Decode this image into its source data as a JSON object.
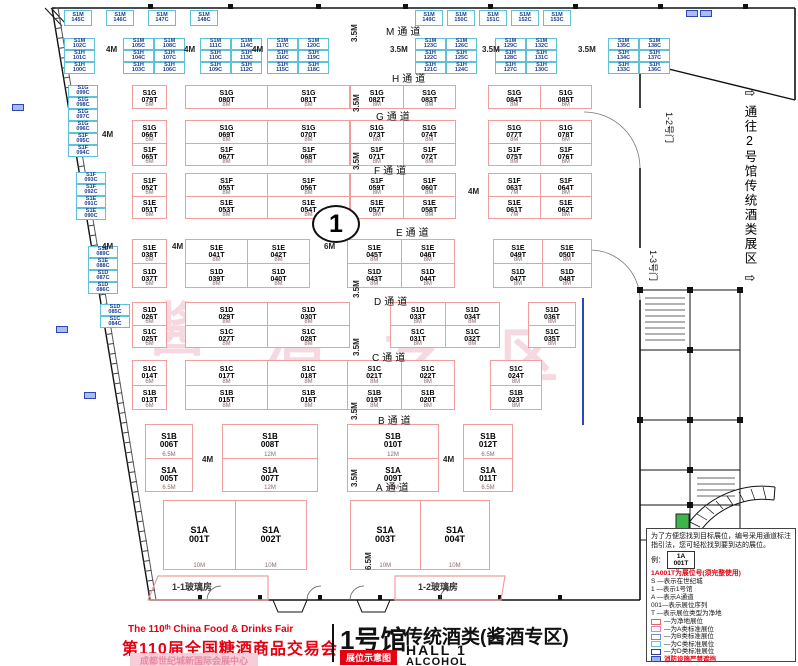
{
  "colors": {
    "net_booth_border": "#ef9d9d",
    "c_booth_border": "#5fc2d9",
    "red_text": "#e60012",
    "fire_blue": "#2a46b8",
    "compass_green": "#3db54a",
    "watermark_pink": "rgba(222,120,145,0.28)"
  },
  "header": {
    "fair_en": "The 110ᵗʰ China Food & Drinks Fair",
    "fair_cn": "第110届全国糖酒商品交易会",
    "venue": "成都世纪城新国际会展中心",
    "hall_cn": "1号馆",
    "map_badge": "展位示意图",
    "subtitle": "传统酒类(酱酒专区)",
    "hall_en": "HALL 1",
    "category_en": "ALCOHOL"
  },
  "legend": {
    "intro": "为了方便您找到目标展位，编号采用通道标注指引法，您可轻松找到要到达的展位。",
    "example_label": "例：",
    "example_top": "1A",
    "example_bottom": "001T",
    "example_note": "1A001T为展位号(须完整使用)",
    "keys": [
      "S  —表示在世纪城",
      "1  —表示1号馆",
      "A  —表示A通道",
      "001—表示展位序列",
      "T  —表示展位类型为净地"
    ],
    "types": [
      {
        "color": "#e06666",
        "fill": "#ffffff",
        "label": "—为净地展位",
        "red": false
      },
      {
        "color": "#ea7fc0",
        "fill": "#ffffff",
        "label": "—为A类标准展位",
        "red": false
      },
      {
        "color": "#7b86d8",
        "fill": "#ffffff",
        "label": "—为B类标准展位",
        "red": false
      },
      {
        "color": "#5ec8e0",
        "fill": "#ffffff",
        "label": "—为C类标准展位",
        "red": false
      },
      {
        "color": "#2a3a9f",
        "fill": "#ffffff",
        "label": "—为D类标准展位",
        "red": false
      },
      {
        "color": "#2a46b8",
        "fill": "#9db4ef",
        "label": "消防设施严禁遮挡",
        "red": true
      }
    ]
  },
  "corridor": {
    "arrow_top": "⇨",
    "text": "通往2号馆传统酒类展区",
    "arrow_bottom": "⇨"
  },
  "doors": {
    "d12": "1-2号门",
    "d13": "1-3号门"
  },
  "glass_houses": [
    "1-1玻璃房",
    "1-2玻璃房"
  ],
  "circle_marker": {
    "label": "1"
  },
  "watermark": {
    "chars": [
      {
        "t": "酱",
        "x": 148,
        "y": 302
      },
      {
        "t": "酒",
        "x": 266,
        "y": 312
      },
      {
        "t": "专",
        "x": 384,
        "y": 320
      },
      {
        "t": "区",
        "x": 500,
        "y": 328
      }
    ]
  },
  "plan": {
    "aisle_labels": [
      {
        "t": "M通道",
        "x": 386,
        "y": 23
      },
      {
        "t": "H通道",
        "x": 392,
        "y": 70
      },
      {
        "t": "G通道",
        "x": 376,
        "y": 108
      },
      {
        "t": "F通道",
        "x": 374,
        "y": 162
      },
      {
        "t": "E通道",
        "x": 396,
        "y": 224
      },
      {
        "t": "D通道",
        "x": 374,
        "y": 293
      },
      {
        "t": "C通道",
        "x": 372,
        "y": 349
      },
      {
        "t": "B通道",
        "x": 378,
        "y": 412
      },
      {
        "t": "A通道",
        "x": 376,
        "y": 479
      }
    ],
    "dim_labels": [
      {
        "t": "4M",
        "x": 106,
        "y": 45
      },
      {
        "t": "4M",
        "x": 184,
        "y": 45
      },
      {
        "t": "4M",
        "x": 252,
        "y": 45
      },
      {
        "t": "3.5M",
        "x": 390,
        "y": 45
      },
      {
        "t": "3.5M",
        "x": 482,
        "y": 45
      },
      {
        "t": "3.5M",
        "x": 578,
        "y": 45
      },
      {
        "t": "4M",
        "x": 102,
        "y": 130
      },
      {
        "t": "4M",
        "x": 102,
        "y": 242
      },
      {
        "t": "4M",
        "x": 172,
        "y": 242
      },
      {
        "t": "6M",
        "x": 324,
        "y": 242
      },
      {
        "t": "4M",
        "x": 468,
        "y": 187
      },
      {
        "t": "4M",
        "x": 202,
        "y": 455
      },
      {
        "t": "4M",
        "x": 443,
        "y": 455
      }
    ],
    "vdim_labels": [
      {
        "t": "3.5M",
        "x": 350,
        "y": 42
      },
      {
        "t": "3.5M",
        "x": 352,
        "y": 112
      },
      {
        "t": "3.5M",
        "x": 352,
        "y": 170
      },
      {
        "t": "7M",
        "x": 352,
        "y": 230
      },
      {
        "t": "3.5M",
        "x": 352,
        "y": 298
      },
      {
        "t": "3.5M",
        "x": 352,
        "y": 356
      },
      {
        "t": "3.5M",
        "x": 350,
        "y": 420
      },
      {
        "t": "3.5M",
        "x": 350,
        "y": 487
      },
      {
        "t": "6.5M",
        "x": 364,
        "y": 570
      }
    ],
    "fire_boxes": [
      {
        "x": 686,
        "y": 10
      },
      {
        "x": 700,
        "y": 10
      },
      {
        "x": 12,
        "y": 104
      },
      {
        "x": 56,
        "y": 326
      },
      {
        "x": 84,
        "y": 392
      }
    ],
    "net_rows": [
      {
        "y": 85,
        "h": 24,
        "d": 0,
        "cls": "",
        "blocks": [
          {
            "x": 132,
            "w": 35,
            "cells": [
              [
                "S1G 079T",
                "6M"
              ]
            ]
          },
          {
            "x": 185,
            "w": 165,
            "cells": [
              [
                "S1G 080T",
                "8M"
              ],
              [
                "S1G 081T",
                "8M"
              ]
            ]
          },
          {
            "x": 350,
            "w": 106,
            "cells": [
              [
                "S1G 082T",
                "8M"
              ],
              [
                "S1G 083T",
                "8M"
              ]
            ]
          },
          {
            "x": 488,
            "w": 104,
            "cells": [
              [
                "S1G 084T",
                "8M"
              ],
              [
                "S1G 085T",
                "6M"
              ]
            ]
          }
        ]
      },
      {
        "y": 120,
        "h": 46,
        "d": 1,
        "cls": "",
        "blocks": [
          {
            "x": 132,
            "w": 35,
            "cells": [
              [
                "S1G 066T",
                "S1F 065T",
                "6M"
              ]
            ]
          },
          {
            "x": 185,
            "w": 165,
            "cells": [
              [
                "S1G 069T",
                "S1F 067T",
                "8M"
              ],
              [
                "S1G 070T",
                "S1F 068T",
                "8M"
              ]
            ]
          },
          {
            "x": 350,
            "w": 106,
            "cells": [
              [
                "S1G 073T",
                "S1F 071T",
                "8M"
              ],
              [
                "S1G 074T",
                "S1F 072T",
                "8M"
              ]
            ]
          },
          {
            "x": 488,
            "w": 104,
            "cells": [
              [
                "S1G 077T",
                "S1F 075T",
                "8M"
              ],
              [
                "S1G 078T",
                "S1F 076T",
                "6M"
              ]
            ]
          }
        ]
      },
      {
        "y": 173,
        "h": 46,
        "d": 1,
        "cls": "",
        "blocks": [
          {
            "x": 132,
            "w": 35,
            "cells": [
              [
                "S1F 052T",
                "S1E 051T",
                "6M"
              ]
            ]
          },
          {
            "x": 185,
            "w": 165,
            "cells": [
              [
                "S1F 055T",
                "S1E 053T",
                "8M"
              ],
              [
                "S1F 056T",
                "S1E 054T",
                "8M"
              ]
            ]
          },
          {
            "x": 350,
            "w": 106,
            "cells": [
              [
                "S1F 059T",
                "S1E 057T",
                "8M"
              ],
              [
                "S1F 060T",
                "S1E 058T",
                "8M"
              ]
            ]
          },
          {
            "x": 488,
            "w": 104,
            "cells": [
              [
                "S1F 063T",
                "S1E 061T",
                "7M"
              ],
              [
                "S1F 064T",
                "S1E 062T",
                "8M"
              ]
            ]
          }
        ]
      },
      {
        "y": 239,
        "h": 49,
        "d": 1,
        "cls": "",
        "blocks": [
          {
            "x": 132,
            "w": 35,
            "cells": [
              [
                "S1E 038T",
                "S1D 037T",
                "6M"
              ]
            ]
          },
          {
            "x": 185,
            "w": 125,
            "cells": [
              [
                "S1E 041T",
                "S1D 039T",
                "8M"
              ],
              [
                "S1E 042T",
                "S1D 040T",
                "8M"
              ]
            ]
          },
          {
            "x": 347,
            "w": 108,
            "cells": [
              [
                "S1E 045T",
                "S1D 043T",
                "8M"
              ],
              [
                "S1E 046T",
                "S1D 044T",
                "8M"
              ]
            ]
          },
          {
            "x": 493,
            "w": 99,
            "cells": [
              [
                "S1E 049T",
                "S1D 047T",
                "8M"
              ],
              [
                "S1E 050T",
                "S1D 048T",
                "8M"
              ]
            ]
          }
        ]
      },
      {
        "y": 302,
        "h": 46,
        "d": 1,
        "cls": "",
        "blocks": [
          {
            "x": 132,
            "w": 35,
            "cells": [
              [
                "S1D 026T",
                "S1C 025T",
                "6M"
              ]
            ]
          },
          {
            "x": 185,
            "w": 165,
            "cells": [
              [
                "S1D 029T",
                "S1C 027T",
                "8M"
              ],
              [
                "S1D 030T",
                "S1C 028T",
                "8M"
              ]
            ]
          },
          {
            "x": 390,
            "w": 110,
            "cells": [
              [
                "S1D 033T",
                "S1C 031T",
                "8M"
              ],
              [
                "S1D 034T",
                "S1C 032T",
                "8M"
              ]
            ]
          },
          {
            "x": 528,
            "w": 48,
            "cells": [
              [
                "S1D 036T",
                "S1C 035T",
                "8M"
              ]
            ]
          }
        ]
      },
      {
        "y": 360,
        "h": 50,
        "d": 1,
        "cls": "",
        "blocks": [
          {
            "x": 132,
            "w": 35,
            "cells": [
              [
                "S1C 014T",
                "S1B 013T",
                "6M"
              ]
            ]
          },
          {
            "x": 185,
            "w": 165,
            "cells": [
              [
                "S1C 017T",
                "S1B 015T",
                "8M"
              ],
              [
                "S1C 018T",
                "S1B 016T",
                "8M"
              ]
            ]
          },
          {
            "x": 347,
            "w": 108,
            "cells": [
              [
                "S1C 021T",
                "S1B 019T",
                "8M"
              ],
              [
                "S1C 022T",
                "S1B 020T",
                "8M"
              ]
            ]
          },
          {
            "x": 490,
            "w": 52,
            "cells": [
              [
                "S1C 024T",
                "S1B 023T",
                "8M"
              ]
            ]
          }
        ]
      },
      {
        "y": 424,
        "h": 68,
        "d": 1,
        "cls": "med",
        "blocks": [
          {
            "x": 145,
            "w": 48,
            "cells": [
              [
                "S1B 006T",
                "S1A 005T",
                "6.5M"
              ]
            ]
          },
          {
            "x": 222,
            "w": 96,
            "cells": [
              [
                "S1B 008T",
                "S1A 007T",
                "12M"
              ]
            ]
          },
          {
            "x": 347,
            "w": 92,
            "cells": [
              [
                "S1B 010T",
                "S1A 009T",
                "12M"
              ]
            ]
          },
          {
            "x": 463,
            "w": 50,
            "cells": [
              [
                "S1B 012T",
                "S1A 011T",
                "6.5M"
              ]
            ]
          }
        ]
      },
      {
        "y": 500,
        "h": 70,
        "d": 0,
        "cls": "big",
        "blocks": [
          {
            "x": 163,
            "w": 144,
            "cells": [
              [
                "S1A 001T",
                "10M"
              ],
              [
                "S1A 002T",
                "10M"
              ]
            ]
          },
          {
            "x": 350,
            "w": 140,
            "cells": [
              [
                "S1A 003T",
                "10M"
              ],
              [
                "S1A 004T",
                "10M"
              ]
            ]
          }
        ]
      }
    ],
    "c_groups": [
      {
        "x": 64,
        "y": 10,
        "cw": 28,
        "ch": 16,
        "cols": 4,
        "gap": 14,
        "cells": [
          "S1M 145C",
          "S1M 146C",
          "S1M 147C",
          "S1M 148C"
        ]
      },
      {
        "x": 415,
        "y": 10,
        "cw": 28,
        "ch": 16,
        "cols": 5,
        "gap": 4,
        "cells": [
          "S1M 149C",
          "S1M 150C",
          "S1M 151C",
          "S1M 152C",
          "S1M 153C"
        ]
      },
      {
        "x": 64,
        "y": 38,
        "cw": 31,
        "ch": 12,
        "cols": 1,
        "gap": 0,
        "cells": [
          "S1M 102C",
          "S1H 101C",
          "S1H 100C"
        ]
      },
      {
        "x": 123,
        "y": 38,
        "cw": 31,
        "ch": 12,
        "cols": 2,
        "gap": 0,
        "cells": [
          "S1M 105C",
          "S1M 108C",
          "S1H 104C",
          "S1H 107C",
          "S1H 103C",
          "S1H 106C"
        ]
      },
      {
        "x": 200,
        "y": 38,
        "cw": 31,
        "ch": 12,
        "cols": 2,
        "gap": 0,
        "cells": [
          "S1M 111C",
          "S1M 114C",
          "S1H 110C",
          "S1H 113C",
          "S1H 109C",
          "S1H 112C"
        ]
      },
      {
        "x": 267,
        "y": 38,
        "cw": 31,
        "ch": 12,
        "cols": 2,
        "gap": 0,
        "cells": [
          "S1M 117C",
          "S1M 120C",
          "S1H 116C",
          "S1H 119C",
          "S1H 115C",
          "S1H 118C"
        ]
      },
      {
        "x": 415,
        "y": 38,
        "cw": 31,
        "ch": 12,
        "cols": 2,
        "gap": 0,
        "cells": [
          "S1M 123C",
          "S1M 126C",
          "S1H 122C",
          "S1H 125C",
          "S1H 121C",
          "S1H 124C"
        ]
      },
      {
        "x": 495,
        "y": 38,
        "cw": 31,
        "ch": 12,
        "cols": 2,
        "gap": 0,
        "cells": [
          "S1M 129C",
          "S1M 132C",
          "S1H 128C",
          "S1H 131C",
          "S1H 127C",
          "S1H 130C"
        ]
      },
      {
        "x": 608,
        "y": 38,
        "cw": 31,
        "ch": 12,
        "cols": 2,
        "gap": 0,
        "cells": [
          "S1M 135C",
          "S1M 138C",
          "S1H 134C",
          "S1H 137C",
          "S1H 133C",
          "S1H 136C"
        ]
      },
      {
        "x": 68,
        "y": 85,
        "cw": 30,
        "ch": 12,
        "cols": 1,
        "gap": 0,
        "cells": [
          "S1G 099C",
          "S1G 098C",
          "S1G 097C",
          "S1G 096C",
          "S1F 095C",
          "S1F 094C"
        ]
      },
      {
        "x": 76,
        "y": 172,
        "cw": 30,
        "ch": 12,
        "cols": 1,
        "gap": 0,
        "cells": [
          "S1F 093C",
          "S1F 092C",
          "S1E 091C",
          "S1E 090C"
        ]
      },
      {
        "x": 88,
        "y": 246,
        "cw": 30,
        "ch": 12,
        "cols": 1,
        "gap": 0,
        "cells": [
          "S1E 089C",
          "S1E 088C",
          "S1D 087C",
          "S1D 086C"
        ]
      },
      {
        "x": 100,
        "y": 304,
        "cw": 30,
        "ch": 12,
        "cols": 1,
        "gap": 0,
        "cells": [
          "S1D 085C",
          "S1C 084C"
        ]
      }
    ]
  }
}
